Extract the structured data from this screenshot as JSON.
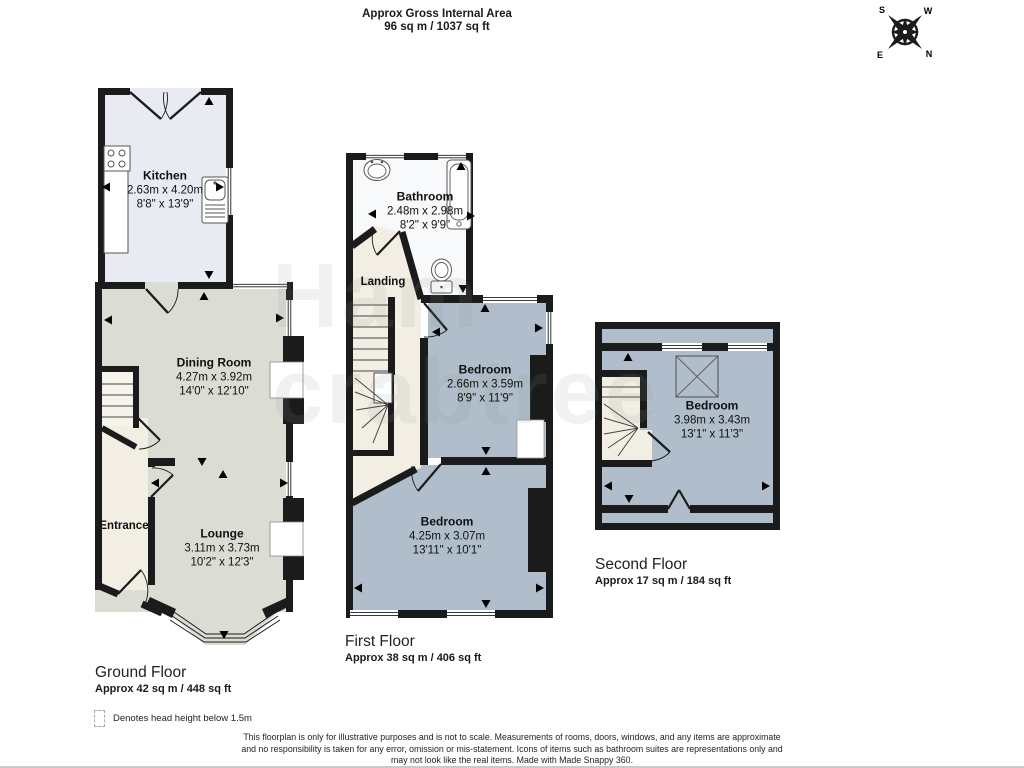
{
  "header": {
    "line1": "Approx Gross Internal Area",
    "line2": "96 sq m / 1037 sq ft"
  },
  "compass": {
    "s": "S",
    "w": "W",
    "n": "N",
    "e": "E"
  },
  "watermark": {
    "line1": "Ham",
    "line2": "crabtree"
  },
  "floors": {
    "ground": {
      "title": "Ground Floor",
      "area": "Approx 42 sq m / 448 sq ft",
      "rooms": {
        "kitchen": {
          "name": "Kitchen",
          "metric": "2.63m x 4.20m",
          "imperial": "8'8\" x 13'9\""
        },
        "dining": {
          "name": "Dining Room",
          "metric": "4.27m x 3.92m",
          "imperial": "14'0\" x 12'10\""
        },
        "entrance": {
          "name": "Entrance"
        },
        "lounge": {
          "name": "Lounge",
          "metric": "3.11m x 3.73m",
          "imperial": "10'2\" x 12'3\""
        }
      }
    },
    "first": {
      "title": "First Floor",
      "area": "Approx 38 sq m / 406 sq ft",
      "rooms": {
        "bathroom": {
          "name": "Bathroom",
          "metric": "2.48m x 2.98m",
          "imperial": "8'2\" x 9'9\""
        },
        "landing": {
          "name": "Landing"
        },
        "bedroom_rear": {
          "name": "Bedroom",
          "metric": "2.66m x 3.59m",
          "imperial": "8'9\" x 11'9\""
        },
        "bedroom_front": {
          "name": "Bedroom",
          "metric": "4.25m x 3.07m",
          "imperial": "13'11\" x 10'1\""
        }
      }
    },
    "second": {
      "title": "Second Floor",
      "area": "Approx 17 sq m / 184 sq ft",
      "rooms": {
        "bedroom": {
          "name": "Bedroom",
          "metric": "3.98m x 3.43m",
          "imperial": "13'1\" x 11'3\""
        }
      }
    }
  },
  "legend": {
    "head_height": "Denotes head height below 1.5m"
  },
  "disclaimer": {
    "line1": "This floorplan is only for illustrative purposes and is not to scale. Measurements of rooms, doors, windows, and any items are approximate",
    "line2": "and no responsibility is taken for any error, omission or mis-statement. Icons of items such as bathroom suites are representations only and",
    "line3": "may not look like the real items. Made with Made Snappy 360."
  },
  "colors": {
    "wall": "#1b1b1b",
    "floor_beige": "#dbdcd4",
    "floor_blue": "#afbeca",
    "floor_cream": "#f3eee3",
    "floor_kitchen": "#e8ebf1",
    "floor_bathroom": "#f8f9fb"
  }
}
